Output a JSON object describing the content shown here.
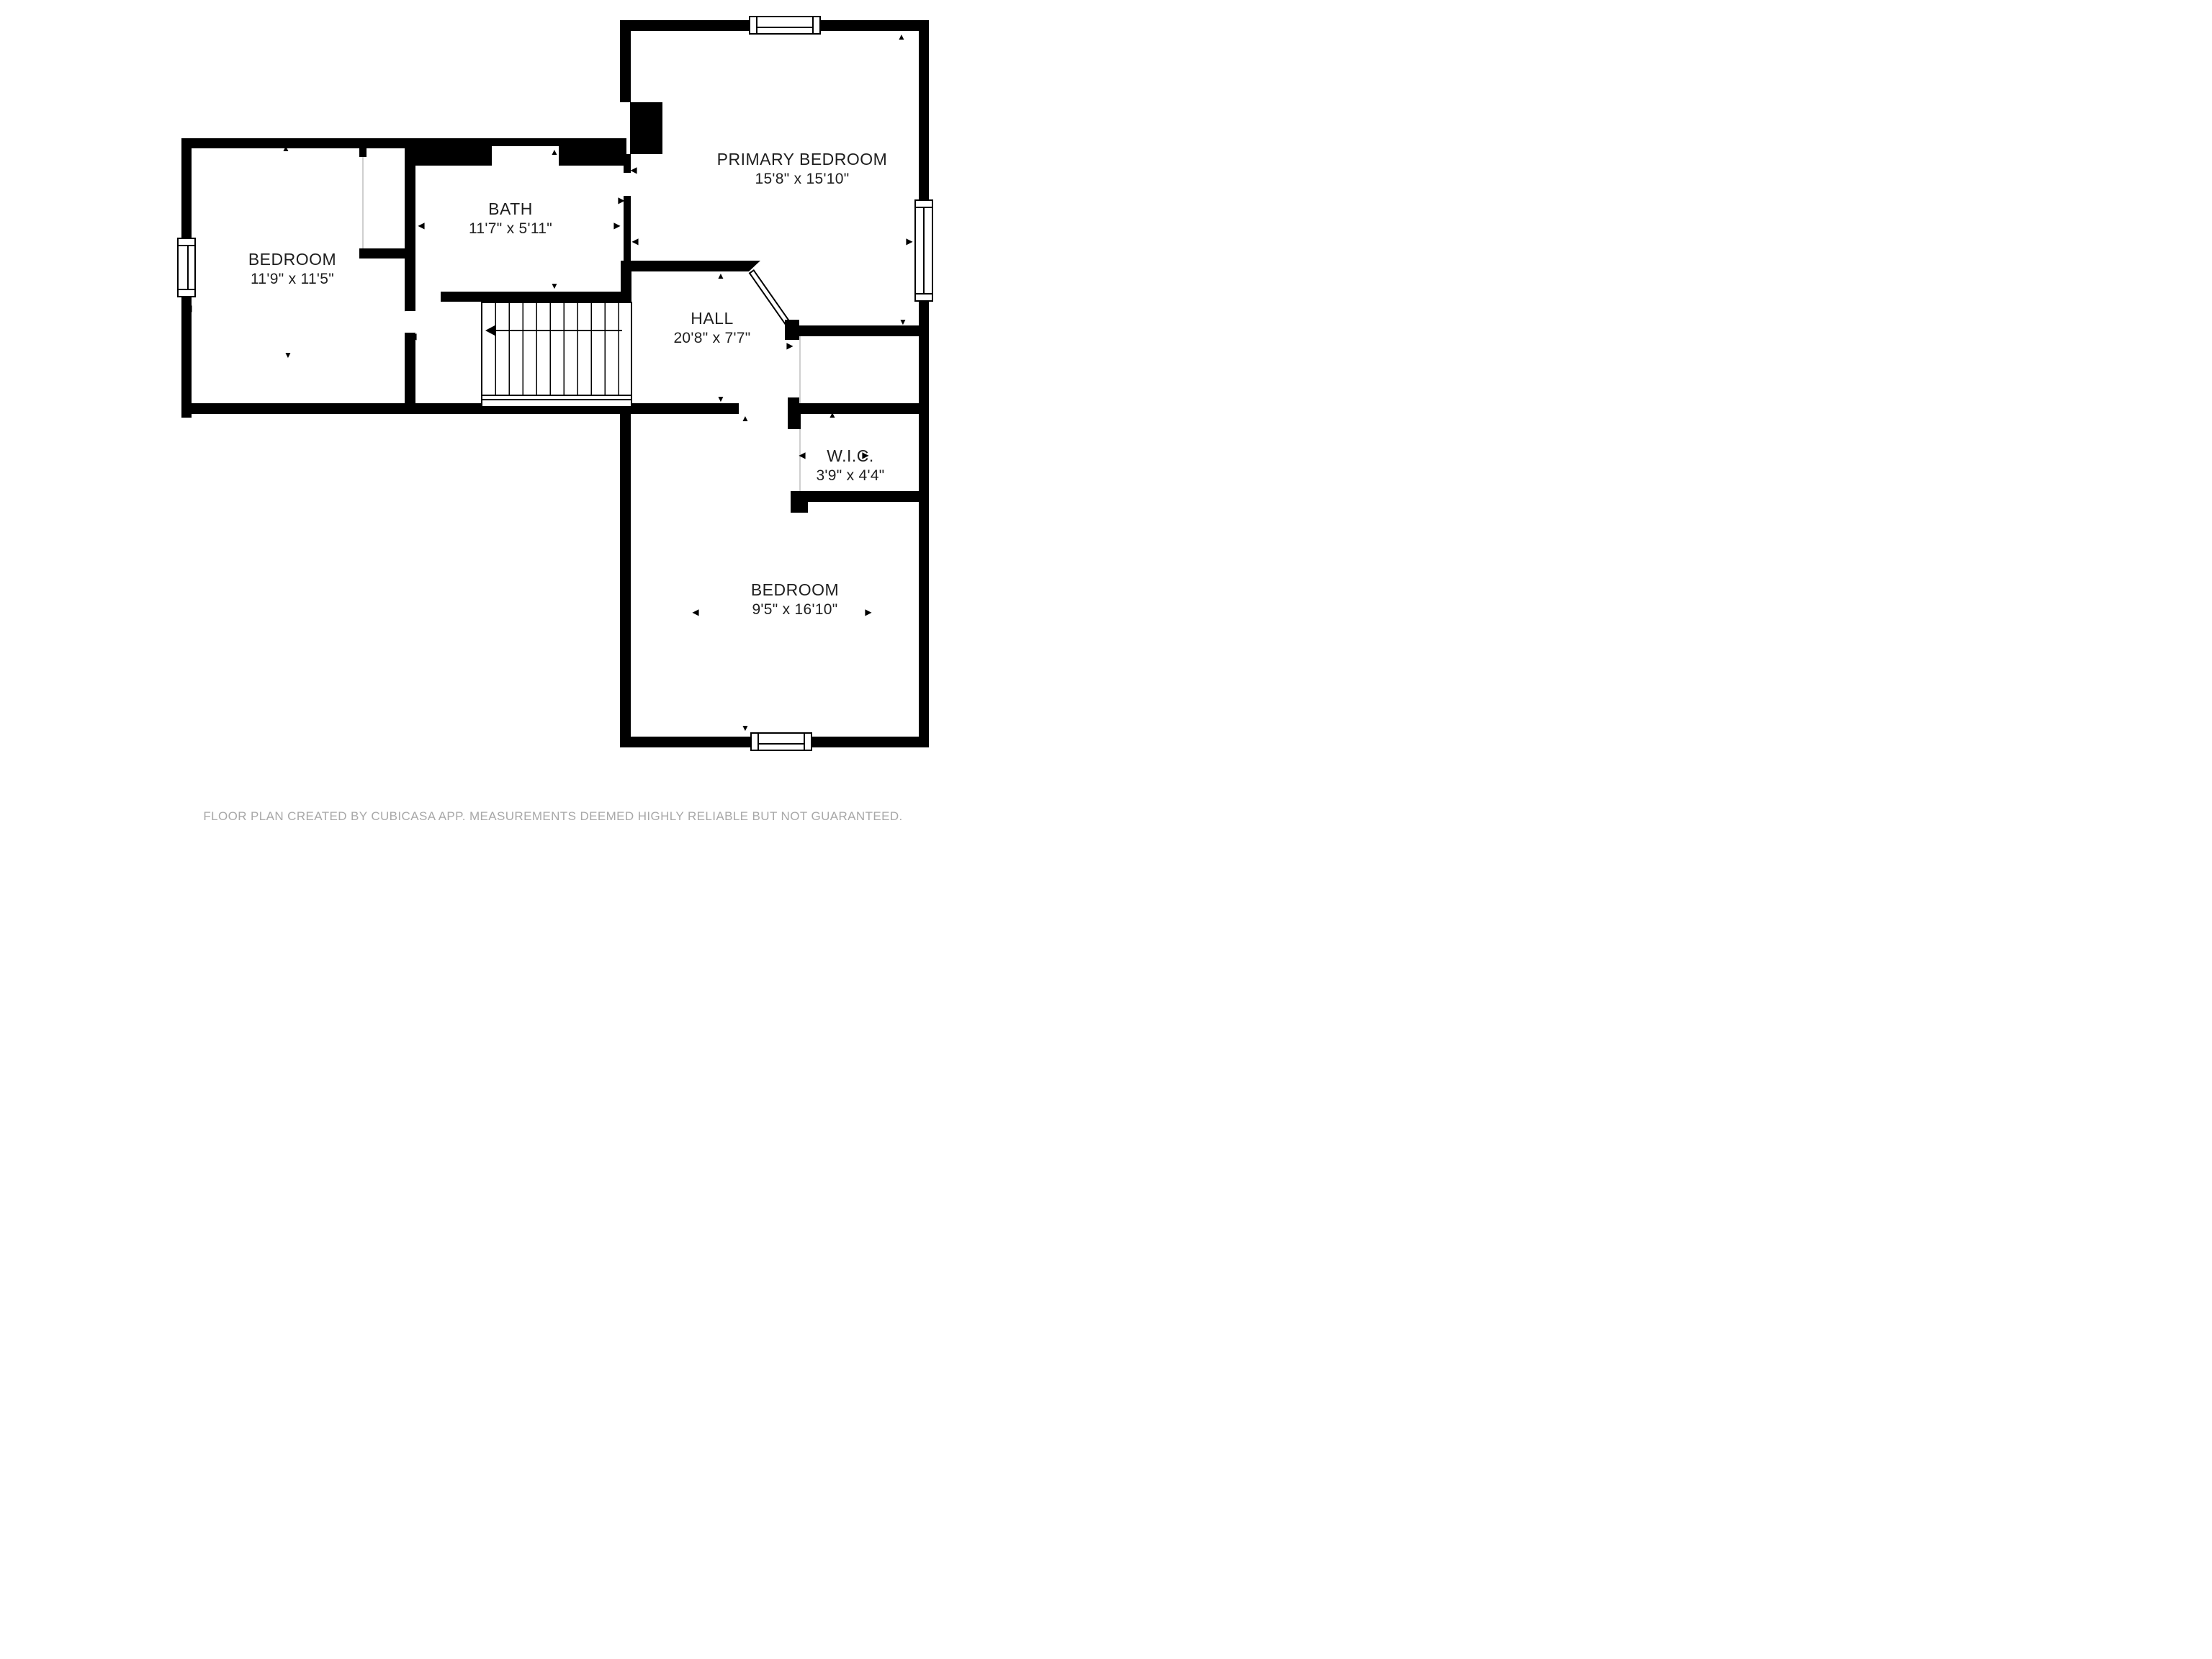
{
  "palette": {
    "wall": "#000000",
    "room_fill": "#ffffff",
    "label_text": "#1f1f1f",
    "footer_text": "#a8a8a8"
  },
  "rooms": [
    {
      "id": "primary-bedroom",
      "name": "PRIMARY BEDROOM",
      "dimensions": "15'8\" x 15'10\""
    },
    {
      "id": "bath",
      "name": "BATH",
      "dimensions": "11'7\" x 5'11\""
    },
    {
      "id": "bedroom-left",
      "name": "BEDROOM",
      "dimensions": "11'9\" x 11'5\""
    },
    {
      "id": "hall",
      "name": "HALL",
      "dimensions": "20'8\" x 7'7\""
    },
    {
      "id": "wic",
      "name": "W.I.C.",
      "dimensions": "3'9\" x 4'4\""
    },
    {
      "id": "bedroom-bottom",
      "name": "BEDROOM",
      "dimensions": "9'5\" x 16'10\""
    }
  ],
  "icons": {
    "arrow_up": "▲",
    "arrow_down": "▼",
    "arrow_left": "◀",
    "arrow_right": "▶"
  },
  "footer": {
    "text": "FLOOR PLAN CREATED BY CUBICASA APP. MEASUREMENTS DEEMED HIGHLY RELIABLE BUT NOT GUARANTEED."
  }
}
